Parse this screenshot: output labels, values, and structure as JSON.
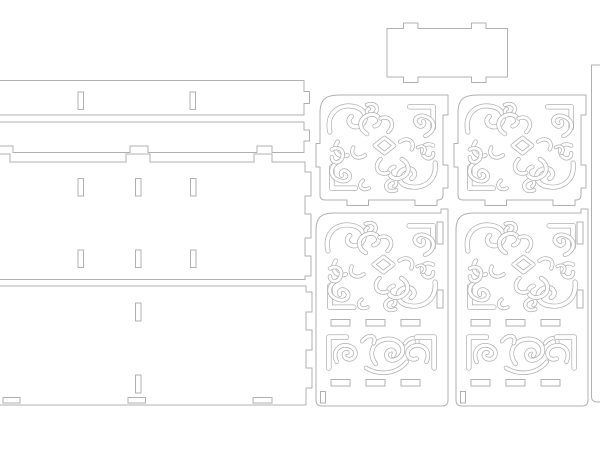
{
  "canvas": {
    "width": 600,
    "height": 450
  },
  "colors": {
    "background": "#ffffff",
    "cut_line": "#b0b0b0",
    "panel_fill": "#ffffff"
  },
  "line_width": 1,
  "motifs": {
    "arabesque": {
      "w": 120,
      "h": 100,
      "strokes": [
        {
          "d": "M6 34 C2 14 16 4 32 8 C44 11 46 24 36 28 C28 31 22 23 28 18",
          "lw": 5.2
        },
        {
          "d": "M14 44 C8 52 14 62 24 58",
          "lw": 4.6
        },
        {
          "d": "M44 6 C54 2 58 12 50 16 C44 18 42 12 46 10",
          "lw": 4.2
        },
        {
          "d": "M88 8 L112 8 L112 30",
          "lw": 5.6
        },
        {
          "d": "M104 38 C114 34 116 22 104 18 C96 15 90 22 96 27 C100 30 104 27 102 23",
          "lw": 4.6
        },
        {
          "d": "M112 48 C104 44 98 50 102 58 C105 63 112 62 112 56",
          "lw": 4.4
        },
        {
          "d": "M114 66 C116 84 102 94 86 90 C74 87 74 74 84 72 C92 70 96 78 90 82",
          "lw": 5.2
        },
        {
          "d": "M74 94 C64 98 60 88 68 84 C74 81 76 88 72 90",
          "lw": 4.2
        },
        {
          "d": "M8 70 L8 92 L32 92",
          "lw": 5.6
        },
        {
          "d": "M16 64 C6 68 4 80 16 84 C24 87 30 80 24 75 C20 72 16 75 18 79",
          "lw": 4.6
        },
        {
          "d": "M8 52 C16 48 22 54 18 62 C15 67 8 66 8 60",
          "lw": 4.4
        },
        {
          "d": "M52 48 L62 40 L72 48 L62 56 Z",
          "lw": 4.4
        },
        {
          "d": "M44 36 C34 30 36 18 48 16 C58 15 60 26 52 28",
          "lw": 4.8
        },
        {
          "d": "M80 62 C90 68 88 80 76 82 C66 83 64 72 72 70",
          "lw": 4.8
        },
        {
          "d": "M58 62 C50 70 56 80 66 76",
          "lw": 4.4
        },
        {
          "d": "M66 34 C74 26 68 16 58 20",
          "lw": 4.4
        },
        {
          "d": "M78 44 C86 38 94 44 90 52",
          "lw": 4.2
        },
        {
          "d": "M42 58 C34 64 26 58 30 50",
          "lw": 4.2
        },
        {
          "d": "M46 92 C38 96 34 88 40 84",
          "lw": 4.0
        },
        {
          "d": "M96 50 C102 46 106 52 102 56",
          "lw": 3.6
        }
      ]
    },
    "band": {
      "w": 120,
      "h": 44,
      "strokes": [
        {
          "d": "M6 38 L6 8 L24 8",
          "lw": 5.6
        },
        {
          "d": "M14 32 C8 20 20 12 30 18 C37 23 32 32 24 29 C20 27 21 22 25 23",
          "lw": 4.6
        },
        {
          "d": "M54 34 C44 22 54 8 70 10 C84 12 86 26 74 30 C66 33 62 24 68 21 C72 19 75 23 72 26",
          "lw": 4.8
        },
        {
          "d": "M44 38 C58 46 76 44 86 32",
          "lw": 4.4
        },
        {
          "d": "M40 12 C46 4 56 6 52 14",
          "lw": 4.2
        },
        {
          "d": "M84 14 C90 6 100 8 96 16",
          "lw": 4.2
        },
        {
          "d": "M114 38 L114 8 L96 8",
          "lw": 5.6
        },
        {
          "d": "M106 32 C112 20 100 12 90 18 C83 23 88 32 96 29",
          "lw": 4.6
        }
      ]
    }
  },
  "panels": [
    {
      "name": "top-rail",
      "outline": "M-8 80.5 H304 V91.5 H309.5 V103.5 H304 V115 H-8 Z",
      "slots": [
        [
          78,
          92,
          5.5,
          17.5
        ],
        [
          190,
          92,
          5.5,
          17.5
        ]
      ]
    },
    {
      "name": "second-rail",
      "outline": "M-8 122 H304 V130 H309.5 V141 H304 V152.5 H272 V146 H257 V152.5 H148 V146 H130 V152.5 H13 V146 H-8 Z",
      "slots": []
    },
    {
      "name": "middle-long-panel",
      "outline": "M-8 154 H10 V162 H126 V154 H150 V162 H254 V154 H272 V162 H305 V172 H311 V196 H305 V214 H311 V238 H305 V256 H311 V276 H305 V279.5 H-8 Z",
      "slots": [
        [
          78,
          178.5,
          5.5,
          17.5
        ],
        [
          135.5,
          178.5,
          5.5,
          17.5
        ],
        [
          190.5,
          178.5,
          5.5,
          17.5
        ],
        [
          78,
          250,
          5.5,
          17.5
        ],
        [
          135.5,
          250,
          5.5,
          17.5
        ],
        [
          190.5,
          250,
          5.5,
          17.5
        ]
      ]
    },
    {
      "name": "bottom-long-panel",
      "outline": "M-8 286 H306 V292 H312 V312 H306 V330 H312 V350 H306 V368 H312 V388 H306 V405 H-8 Z",
      "slots": [
        [
          135.5,
          303,
          5.5,
          18
        ],
        [
          135.5,
          375,
          5.5,
          18
        ],
        [
          3,
          397.5,
          17,
          5.5
        ],
        [
          128,
          397.5,
          17.5,
          5.5
        ],
        [
          253,
          397.5,
          19,
          5.5
        ]
      ]
    },
    {
      "name": "small-tabbed-panel",
      "outline": "M387 28.5 H403.5 V23 H418 V28.5 H471.5 V23 H486 V28.5 H507.5 V77 H486 V82.5 H471.5 V77 H418 V82.5 H403.5 V77 H387 Z",
      "slots": []
    },
    {
      "name": "square-filigree-left",
      "outline": "M320 113 C320 99 326 95 340 95 H448 V115 H443 V165 H448 V188 H443 V195 Q443 200 438 200 H437 V205.5 H415 V200 H368.5 V205.5 H347 V200 H325 Q320 200 320 195 V167 H316 V143.5 H320 Z",
      "slots": [],
      "ornaments": [
        {
          "motif": "arabesque",
          "x": 324,
          "y": 99,
          "w": 117,
          "h": 97
        }
      ]
    },
    {
      "name": "square-filigree-right",
      "same_as": "square-filigree-left",
      "transform": "translate(138,0)"
    },
    {
      "name": "tall-filigree-left",
      "outline": "M316 230 C316 217 322 213 334 213 H441 V209 H448 V400 Q448 406 442 406 H322 Q316 406 316 400 Z",
      "slots": [
        [
          437,
          222,
          6,
          22
        ],
        [
          437,
          290,
          6,
          18
        ],
        [
          331,
          319.5,
          19,
          6.5
        ],
        [
          366,
          319.5,
          19,
          6.5
        ],
        [
          401,
          319.5,
          19,
          6.5
        ],
        [
          331,
          379.5,
          19,
          6.5
        ],
        [
          366,
          379.5,
          19,
          6.5
        ],
        [
          401,
          379.5,
          19,
          6.5
        ],
        [
          320.5,
          391.5,
          5,
          11.5
        ]
      ],
      "ornaments": [
        {
          "motif": "arabesque",
          "x": 322,
          "y": 218,
          "w": 119,
          "h": 97
        },
        {
          "motif": "band",
          "x": 323,
          "y": 329,
          "w": 117,
          "h": 45
        }
      ]
    },
    {
      "name": "tall-filigree-right",
      "same_as": "tall-filigree-left",
      "transform": "translate(140,0)"
    },
    {
      "name": "right-edge-strip",
      "outline": "M591.5 65 H606 V402 H597 Q591.5 402 591.5 396 Z",
      "slots": []
    }
  ]
}
